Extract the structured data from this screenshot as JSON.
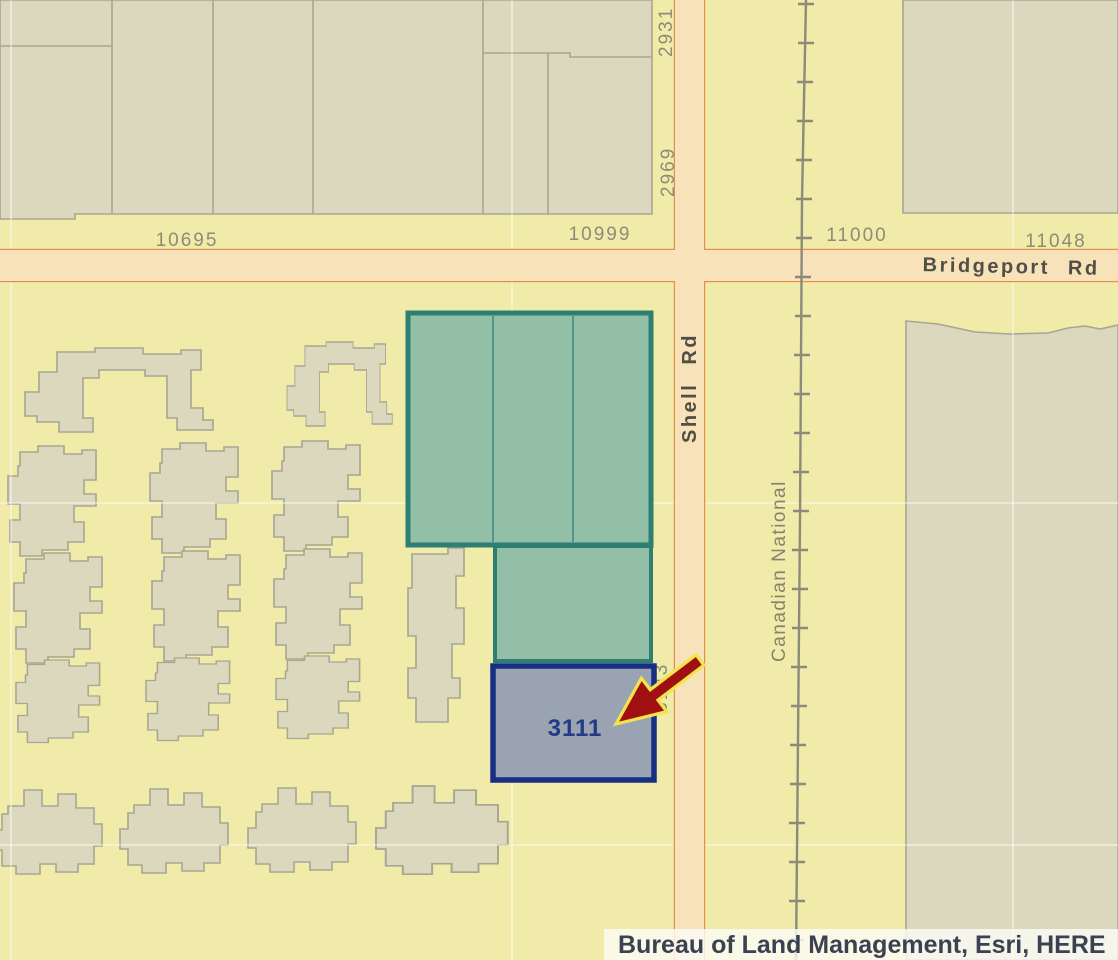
{
  "map": {
    "streets": {
      "bridgeport": "Bridgeport Rd",
      "shell": "Shell Rd"
    },
    "railway_name": "Canadian National",
    "address_labels": {
      "n10695": "10695",
      "n10999": "10999",
      "n11000": "11000",
      "n11048": "11048",
      "n2969": "2969",
      "n2931": "2931",
      "n3143": "3143"
    },
    "parcel": {
      "number": "3111"
    },
    "attribution": "Bureau of Land Management, Esri, HERE",
    "colors": {
      "background": "#f0eba8",
      "building_fill": "#dcd8bd",
      "building_stroke": "#a8a593",
      "road_fill": "#f8e2ba",
      "road_stroke": "#e78c4e",
      "railway": "#8c8b7b",
      "parcel_green_fill": "#8ebda6",
      "parcel_green_stroke": "#2e7f73",
      "parcel_green_inner": "#4e978a",
      "parcel_blue_fill": "#99a3b2",
      "parcel_blue_stroke": "#162f82",
      "parcel_label": "#233a86",
      "arrow_fill": "#a01010",
      "arrow_stroke": "#f2e44a",
      "label_gray": "#8e8b79",
      "street_label": "#4f4f45",
      "attribution_bg": "rgba(252,252,248,0.8)",
      "attribution_text": "#3a4150"
    }
  }
}
